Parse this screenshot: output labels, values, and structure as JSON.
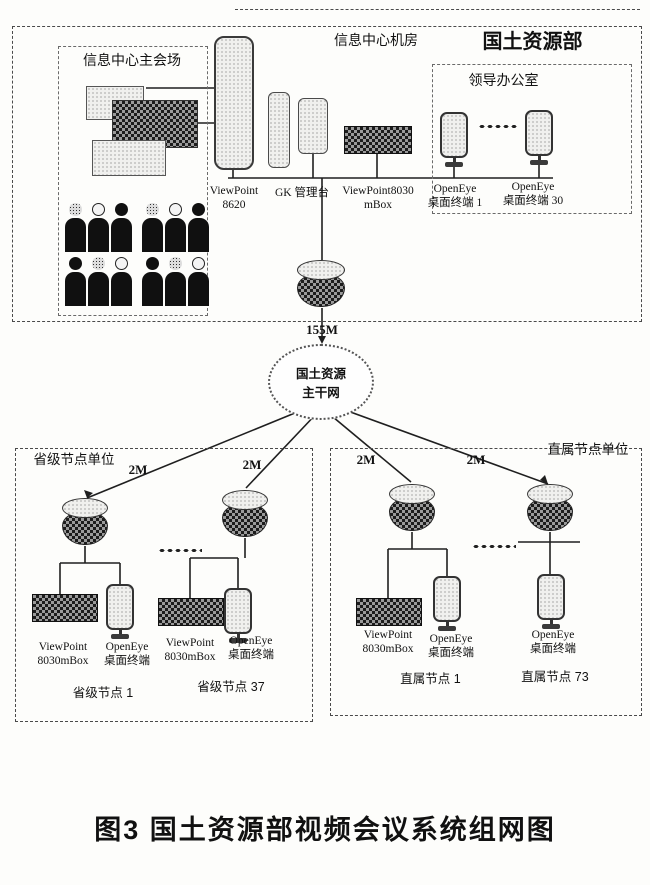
{
  "top_section": {
    "title": "国土资源部",
    "main_venue_label": "信息中心主会场",
    "machine_room_label": "信息中心机房",
    "leader_office_label": "领导办公室",
    "devices": {
      "mcu": {
        "line1": "ViewPoint",
        "line2": "8620"
      },
      "gk": {
        "line1": "GK 管理台"
      },
      "mbox": {
        "line1": "ViewPoint8030",
        "line2": "mBox"
      },
      "terminal1": {
        "line1": "OpenEye",
        "line2": "桌面终端 1"
      },
      "terminal30": {
        "line1": "OpenEye",
        "line2": "桌面终端 30"
      }
    }
  },
  "backbone": {
    "uplink_bandwidth": "155M",
    "cloud_line1": "国土资源",
    "cloud_line2": "主干网",
    "branch_bandwidth": "2M"
  },
  "provincial_section": {
    "label": "省级节点单位",
    "node1": {
      "mbox_line1": "ViewPoint",
      "mbox_line2": "8030mBox",
      "terminal_line1": "OpenEye",
      "terminal_line2": "桌面终端",
      "name": "省级节点 1"
    },
    "node37": {
      "mbox_line1": "ViewPoint",
      "mbox_line2": "8030mBox",
      "terminal_line1": "OpenEye",
      "terminal_line2": "桌面终端",
      "name": "省级节点 37"
    }
  },
  "affiliated_section": {
    "label": "直属节点单位",
    "node1": {
      "mbox_line1": "ViewPoint",
      "mbox_line2": "8030mBox",
      "terminal_line1": "OpenEye",
      "terminal_line2": "桌面终端",
      "name": "直属节点 1"
    },
    "node73": {
      "terminal_line1": "OpenEye",
      "terminal_line2": "桌面终端",
      "name": "直属节点 73"
    }
  },
  "caption": "图3  国土资源部视频会议系统组网图"
}
